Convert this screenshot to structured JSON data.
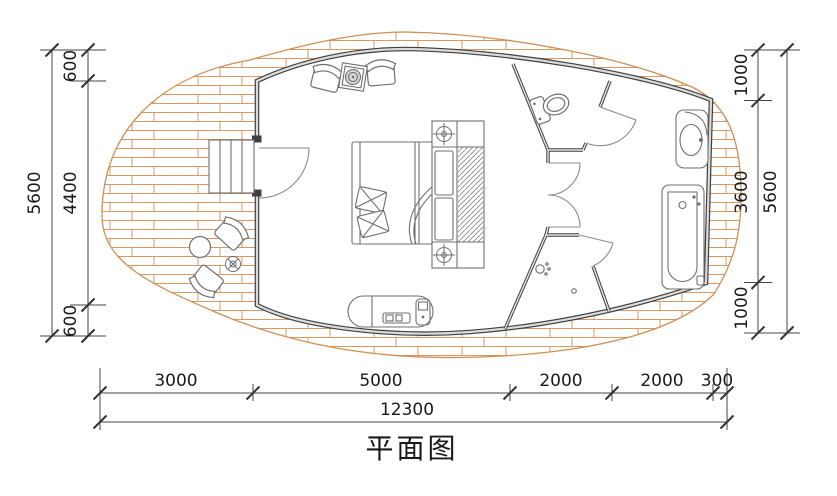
{
  "drawing": {
    "title": "平面图"
  },
  "dimensions": {
    "left": {
      "segments": [
        "600",
        "4400",
        "600"
      ],
      "overall": "5600"
    },
    "right": {
      "segments": [
        "1000",
        "3600",
        "1000"
      ],
      "overall": "5600"
    },
    "bottom": {
      "segments": [
        "3000",
        "5000",
        "2000",
        "2000",
        "300"
      ],
      "overall": "12300"
    }
  },
  "colors": {
    "wall": "#3f3f3f",
    "wall_core": "#dcdcdc",
    "deck_hatch": "#d89a62",
    "furniture_line": "#6f6f6f",
    "dimension_line": "#333333",
    "text": "#1a1a1a"
  }
}
